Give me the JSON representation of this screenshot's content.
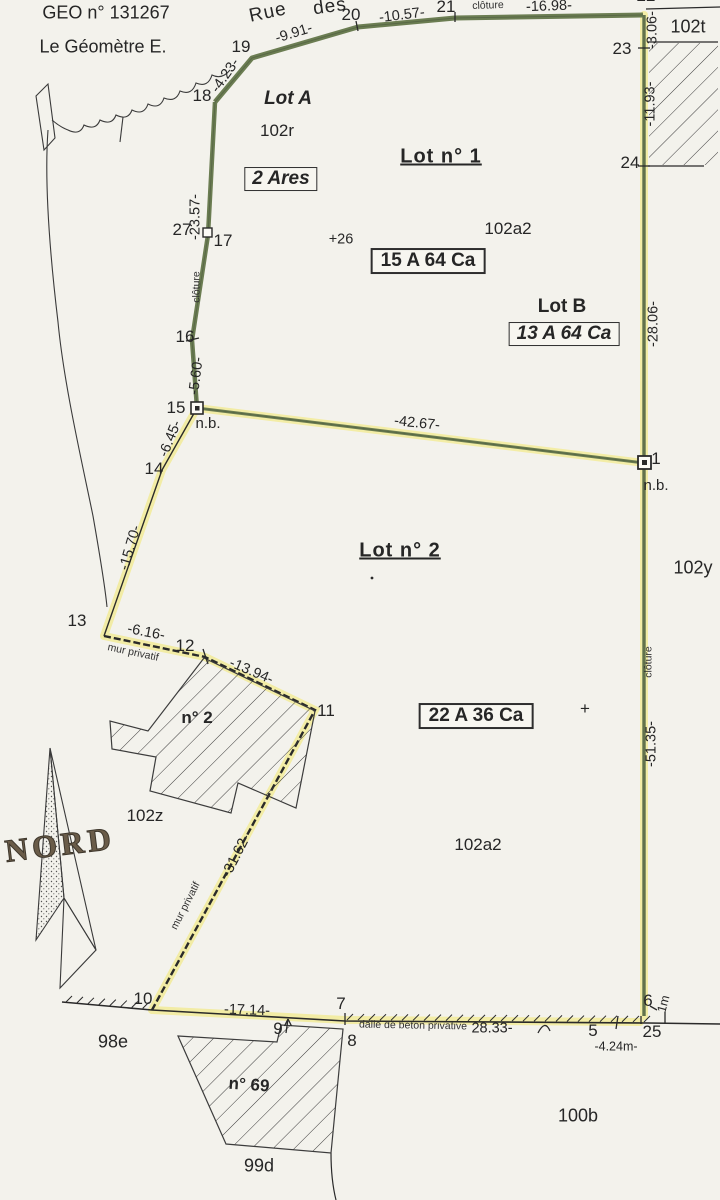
{
  "document": {
    "type": "plan de géomètre (cadastral survey plan)",
    "header": {
      "geo_number": "GEO n° 131267",
      "surveyor": "Le Géomètre E."
    }
  },
  "colors": {
    "paper": "#f3f2ec",
    "boundary_green": "#6b7d52",
    "highlight_yellow": "#f2eca2",
    "ink": "#2a2a2a"
  },
  "plan": {
    "labels": [
      {
        "name": "geo-number",
        "text": "GEO n° 131267",
        "x": 106,
        "y": 13,
        "cls": "h"
      },
      {
        "name": "surveyor-name",
        "text": "Le Géomètre E.",
        "x": 103,
        "y": 47,
        "cls": "h"
      },
      {
        "name": "street-name-rue",
        "text": "Rue",
        "x": 268,
        "y": 13,
        "rot": -12,
        "cls": "street"
      },
      {
        "name": "street-name-des",
        "text": "des",
        "x": 330,
        "y": 7,
        "rot": -8,
        "cls": "street"
      },
      {
        "name": "point-18",
        "text": "18",
        "x": 202,
        "y": 96,
        "cls": "pt"
      },
      {
        "name": "point-19",
        "text": "19",
        "x": 241,
        "y": 47,
        "cls": "pt"
      },
      {
        "name": "point-20",
        "text": "20",
        "x": 351,
        "y": 15,
        "cls": "pt"
      },
      {
        "name": "point-21",
        "text": "21",
        "x": 446,
        "y": 7,
        "cls": "pt"
      },
      {
        "name": "point-22",
        "text": "22",
        "x": 646,
        "y": -4,
        "cls": "pt"
      },
      {
        "name": "point-23",
        "text": "23",
        "x": 622,
        "y": 49,
        "cls": "pt"
      },
      {
        "name": "point-24",
        "text": "24",
        "x": 630,
        "y": 163,
        "cls": "pt"
      },
      {
        "name": "point-27",
        "text": "27",
        "x": 182,
        "y": 230,
        "cls": "pt"
      },
      {
        "name": "point-17",
        "text": "17",
        "x": 223,
        "y": 241,
        "cls": "pt"
      },
      {
        "name": "point-16",
        "text": "16",
        "x": 185,
        "y": 337,
        "cls": "pt"
      },
      {
        "name": "point-15",
        "text": "15",
        "x": 176,
        "y": 408,
        "cls": "pt"
      },
      {
        "name": "point-14",
        "text": "14",
        "x": 154,
        "y": 469,
        "cls": "pt"
      },
      {
        "name": "point-13",
        "text": "13",
        "x": 77,
        "y": 621,
        "cls": "pt"
      },
      {
        "name": "point-12",
        "text": "12",
        "x": 185,
        "y": 646,
        "cls": "pt"
      },
      {
        "name": "point-11",
        "text": "11",
        "x": 326,
        "y": 711,
        "cls": "pt"
      },
      {
        "name": "point-10",
        "text": "10",
        "x": 143,
        "y": 999,
        "cls": "pt"
      },
      {
        "name": "point-9",
        "text": "9",
        "x": 278,
        "y": 1029,
        "cls": "pt"
      },
      {
        "name": "point-8",
        "text": "8",
        "x": 352,
        "y": 1041,
        "cls": "pt"
      },
      {
        "name": "point-7",
        "text": "7",
        "x": 341,
        "y": 1004,
        "cls": "pt"
      },
      {
        "name": "point-5",
        "text": "5",
        "x": 593,
        "y": 1031,
        "cls": "pt"
      },
      {
        "name": "point-6",
        "text": "6",
        "x": 648,
        "y": 1001,
        "cls": "pt"
      },
      {
        "name": "point-25",
        "text": "25",
        "x": 652,
        "y": 1032,
        "cls": "pt"
      },
      {
        "name": "point-1",
        "text": "1",
        "x": 656,
        "y": 459,
        "cls": "pt"
      },
      {
        "name": "meas-4-23",
        "text": "-4.23-",
        "x": 226,
        "y": 76,
        "rot": -55,
        "cls": "m"
      },
      {
        "name": "meas-9-91",
        "text": "-9.91-",
        "x": 294,
        "y": 34,
        "rot": -17,
        "cls": "m"
      },
      {
        "name": "meas-10-57",
        "text": "-10.57-",
        "x": 402,
        "y": 16,
        "rot": -7,
        "cls": "m"
      },
      {
        "name": "meas-16-98",
        "text": "-16.98-",
        "x": 549,
        "y": 7,
        "rot": -2,
        "cls": "m"
      },
      {
        "name": "meas-3-06",
        "text": "-3.06-",
        "x": 653,
        "y": 30,
        "rot": -90,
        "cls": "m"
      },
      {
        "name": "meas-11-93",
        "text": "-11.93-",
        "x": 651,
        "y": 104,
        "rot": -90,
        "cls": "m"
      },
      {
        "name": "meas-23-57",
        "text": "-23.57-",
        "x": 196,
        "y": 217,
        "rot": -90,
        "cls": "m"
      },
      {
        "name": "meas-5-60",
        "text": "-5.60-",
        "x": 197,
        "y": 376,
        "rot": -83,
        "cls": "m"
      },
      {
        "name": "meas-6-45",
        "text": "-6.45-",
        "x": 171,
        "y": 439,
        "rot": -68,
        "cls": "m"
      },
      {
        "name": "meas-15-70",
        "text": "-15.70-",
        "x": 131,
        "y": 548,
        "rot": -74,
        "cls": "m"
      },
      {
        "name": "meas-28-06",
        "text": "-28.06-",
        "x": 654,
        "y": 324,
        "rot": -90,
        "cls": "m"
      },
      {
        "name": "meas-42-67",
        "text": "-42.67-",
        "x": 417,
        "y": 424,
        "rot": 6,
        "cls": "m"
      },
      {
        "name": "meas-6-16",
        "text": "-6.16-",
        "x": 146,
        "y": 633,
        "rot": 11,
        "cls": "m"
      },
      {
        "name": "meas-13-94",
        "text": "-13.94-",
        "x": 251,
        "y": 672,
        "rot": 23,
        "cls": "m"
      },
      {
        "name": "meas-31-62",
        "text": "-31.62-",
        "x": 237,
        "y": 856,
        "rot": -63,
        "cls": "m"
      },
      {
        "name": "meas-51-35",
        "text": "-51.35-",
        "x": 652,
        "y": 744,
        "rot": -90,
        "cls": "m"
      },
      {
        "name": "meas-17-14",
        "text": "-17.14-",
        "x": 247,
        "y": 1011,
        "rot": 2,
        "cls": "m"
      },
      {
        "name": "meas-28-33",
        "text": "28.33-",
        "x": 492,
        "y": 1029,
        "cls": "m"
      },
      {
        "name": "meas-4-24m",
        "text": "-4.24m-",
        "x": 616,
        "y": 1047,
        "cls": "ms"
      },
      {
        "name": "meas-1m",
        "text": "1m",
        "x": 664,
        "y": 1004,
        "rot": -75,
        "cls": "ms"
      },
      {
        "name": "cloture-top",
        "text": "clôture",
        "x": 488,
        "y": 6,
        "rot": -2,
        "cls": "tiny"
      },
      {
        "name": "cloture-left",
        "text": "clôture",
        "x": 197,
        "y": 287,
        "rot": -90,
        "cls": "tiny"
      },
      {
        "name": "cloture-right",
        "text": "clôture",
        "x": 649,
        "y": 662,
        "rot": -90,
        "cls": "tiny"
      },
      {
        "name": "mur-privatif-upper",
        "text": "mur privatif",
        "x": 133,
        "y": 653,
        "rot": 12,
        "cls": "tiny"
      },
      {
        "name": "mur-privatif-lower",
        "text": "mur privatif",
        "x": 186,
        "y": 906,
        "rot": -63,
        "cls": "tiny"
      },
      {
        "name": "dalle-beton",
        "text": "dalle de béton privative",
        "x": 413,
        "y": 1026,
        "rot": 1,
        "cls": "tiny"
      },
      {
        "name": "nb-15",
        "text": "n.b.",
        "x": 208,
        "y": 424,
        "cls": "nb"
      },
      {
        "name": "nb-1",
        "text": "n.b.",
        "x": 656,
        "y": 486,
        "cls": "nb"
      },
      {
        "name": "parcel-102r",
        "text": "102r",
        "x": 277,
        "y": 131,
        "cls": "pc"
      },
      {
        "name": "parcel-102a2-top",
        "text": "102a2",
        "x": 508,
        "y": 229,
        "cls": "pc"
      },
      {
        "name": "parcel-102t",
        "text": "102t",
        "x": 688,
        "y": 27,
        "cls": "pc18"
      },
      {
        "name": "parcel-102y",
        "text": "102y",
        "x": 693,
        "y": 568,
        "cls": "pc18"
      },
      {
        "name": "parcel-102z",
        "text": "102z",
        "x": 145,
        "y": 816,
        "cls": "pc"
      },
      {
        "name": "parcel-102a2-bottom",
        "text": "102a2",
        "x": 478,
        "y": 845,
        "cls": "pc"
      },
      {
        "name": "parcel-98e",
        "text": "98e",
        "x": 113,
        "y": 1042,
        "cls": "pc18"
      },
      {
        "name": "parcel-99d",
        "text": "99d",
        "x": 259,
        "y": 1166,
        "cls": "pc18"
      },
      {
        "name": "parcel-100b",
        "text": "100b",
        "x": 578,
        "y": 1116,
        "cls": "pc18"
      },
      {
        "name": "building-n2",
        "text": "n° 2",
        "x": 197,
        "y": 718,
        "cls": "pc bold"
      },
      {
        "name": "building-n69",
        "text": "n° 69",
        "x": 249,
        "y": 1085,
        "rot": 4,
        "cls": "pc bold"
      },
      {
        "name": "lot-a-title",
        "text": "Lot A",
        "x": 288,
        "y": 99,
        "cls": "lot-sub-i"
      },
      {
        "name": "lot-1-title",
        "text": "Lot n° 1",
        "x": 441,
        "y": 157,
        "cls": "lot-main"
      },
      {
        "name": "lot-b-title",
        "text": "Lot B",
        "x": 562,
        "y": 307,
        "cls": "lot-sub"
      },
      {
        "name": "lot-2-title",
        "text": "Lot n° 2",
        "x": 400,
        "y": 551,
        "cls": "lot-main"
      },
      {
        "name": "area-2-ares",
        "text": "2 Ares",
        "x": 281,
        "y": 179,
        "cls": "box-i"
      },
      {
        "name": "area-15a64ca",
        "text": "15 A 64 Ca",
        "x": 428,
        "y": 261,
        "cls": "box"
      },
      {
        "name": "area-13a64ca",
        "text": "13 A 64 Ca",
        "x": 564,
        "y": 334,
        "cls": "box-i"
      },
      {
        "name": "area-22a36ca",
        "text": "22 A 36 Ca",
        "x": 476,
        "y": 716,
        "cls": "box"
      },
      {
        "name": "point-26",
        "text": "+26",
        "x": 341,
        "y": 240,
        "cls": "m"
      },
      {
        "name": "survey-cross",
        "text": "+",
        "x": 585,
        "y": 709,
        "cls": "plus"
      },
      {
        "name": "north-label",
        "text": "NORD",
        "x": 60,
        "y": 845,
        "rot": -7,
        "cls": "nord"
      }
    ]
  }
}
